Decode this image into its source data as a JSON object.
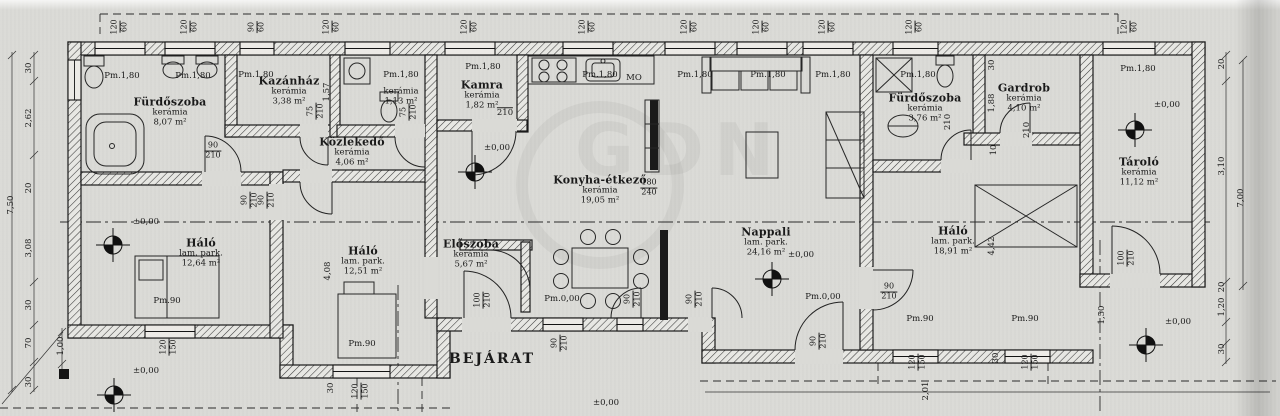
{
  "labels": {
    "bejarat": "BEJÁRAT",
    "zero": "±0,00",
    "pm180": "Pm.1,80",
    "pm90": "Pm.90",
    "pm000": "Pm.0,00",
    "mo": "MO",
    "watermark": "GDN"
  },
  "rooms": [
    {
      "name": "Fürdőszoba",
      "floor": "kerámia",
      "area": "8,07 m²"
    },
    {
      "name": "Kazánház",
      "floor": "kerámia",
      "area": "3,38 m²"
    },
    {
      "name": "",
      "floor": "kerámia",
      "area": "1,13 m²"
    },
    {
      "name": "Kamra",
      "floor": "kerámia",
      "area": "1,82 m²"
    },
    {
      "name": "Közlekedő",
      "floor": "kerámia",
      "area": "4,06 m²"
    },
    {
      "name": "Konyha-étkező",
      "floor": "kerámia",
      "area": "19,05 m²"
    },
    {
      "name": "Nappali",
      "floor": "lam. park.",
      "area": "24,16 m²"
    },
    {
      "name": "Fürdőszoba",
      "floor": "kerámia",
      "area": "3,76 m²"
    },
    {
      "name": "Gardrob",
      "floor": "kerámia",
      "area": "4,10 m²"
    },
    {
      "name": "Tároló",
      "floor": "kerámia",
      "area": "11,12 m²"
    },
    {
      "name": "Háló",
      "floor": "lam. park.",
      "area": "12,64 m²"
    },
    {
      "name": "Háló",
      "floor": "lam. park.",
      "area": "12,51 m²"
    },
    {
      "name": "Háló",
      "floor": "lam. park.",
      "area": "18,91 m²"
    },
    {
      "name": "Előszoba",
      "floor": "kerámia",
      "area": "5,67 m²"
    }
  ],
  "dims": {
    "w120_60": {
      "a": "120",
      "b": "60"
    },
    "w90_60": {
      "a": "90",
      "b": "60"
    },
    "w120_150": {
      "a": "120",
      "b": "150"
    },
    "d90_210": {
      "a": "90",
      "b": "210"
    },
    "d100_210": {
      "a": "100",
      "b": "210"
    },
    "d75_210": {
      "a": "75",
      "b": "210"
    },
    "d180_240": {
      "a": "180",
      "b": "240"
    },
    "v210": "210",
    "kitchen_pass": "210",
    "left": [
      "30",
      "2,62",
      "20",
      "3,08",
      "30",
      "70",
      "30"
    ],
    "left_total": "7,50",
    "left_inner": "1,00",
    "right": [
      "20",
      "3,10",
      "20",
      "1,20",
      "30"
    ],
    "right_inner": "7,00",
    "v30": "30",
    "v10": "10",
    "d408": "4,08",
    "d442": "4,42",
    "d188": "1,88",
    "d201": "2,01",
    "d150": "1,50",
    "d157": "1,57"
  }
}
